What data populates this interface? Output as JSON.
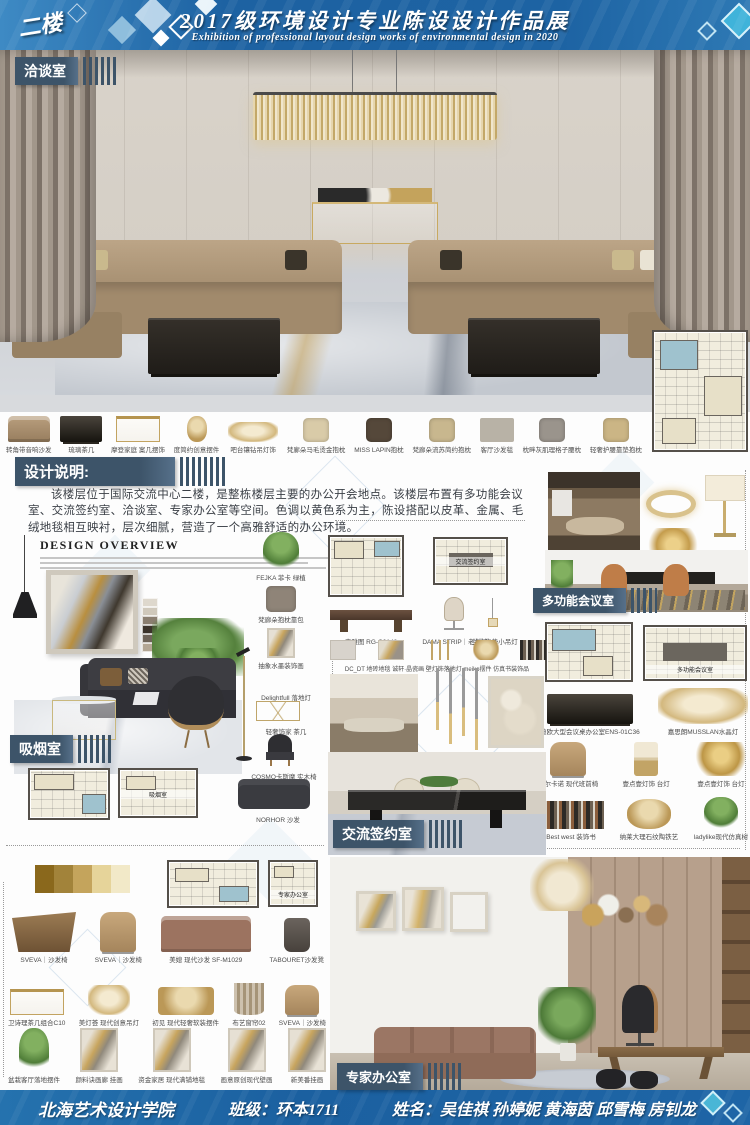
{
  "header": {
    "floor_badge": "二楼",
    "title": "2017级环境设计专业陈设设计作品展",
    "subtitle": "Exhibition of professional layout design works of environmental design in 2020"
  },
  "room_labels": {
    "negotiation": "洽谈室",
    "design_notes": "设计说明:",
    "smoking": "吸烟室",
    "signing": "交流签约室",
    "multifunction": "多功能会议室",
    "expert": "专家办公室"
  },
  "design_notes_text": "该楼层位于国际交流中心二楼，是整栋楼层主要的办公开会地点。该楼层布置有多功能会议室、交流签约室、洽谈室、专家办公室等空间。色调以黄色系为主，陈设搭配以皮革、金属、毛绒地毯相互映衬，层次细腻，营造了一个高雅舒适的办公环境。",
  "furniture_strip": {
    "items": [
      {
        "label": "转角带音响沙发",
        "kind": "sofa"
      },
      {
        "label": "琉璃茶几",
        "kind": "table"
      },
      {
        "label": "摩登家庭 案几摆饰",
        "kind": "console"
      },
      {
        "label": "度简约创意摆件",
        "kind": "decor"
      },
      {
        "label": "吧台镶钻吊灯饰",
        "kind": "chand"
      },
      {
        "label": "梵廊朵马毛烫金抱枕",
        "kind": "pillow",
        "color": "#d9cba8"
      },
      {
        "label": "MISS LAPIN抱枕",
        "kind": "pillow",
        "color": "#55483a"
      },
      {
        "label": "梵廊朵流苏简约抱枕",
        "kind": "pillow",
        "color": "#c8b78e"
      },
      {
        "label": "客厅沙发毯",
        "kind": "rug",
        "color": "#b8b2a6"
      },
      {
        "label": "枕畔灰肌理格子腰枕",
        "kind": "pillow",
        "color": "#9a948c"
      },
      {
        "label": "轻奢护腰靠垫抱枕",
        "kind": "pillow",
        "color": "#cbb585"
      }
    ]
  },
  "overview": {
    "heading": "DESIGN OVERVIEW",
    "palette": [
      "#ded8cd",
      "#cfc8bb",
      "#8a7e70",
      "#3b332b",
      "#6e6459",
      "#b3a694"
    ],
    "side_items": [
      {
        "label": "FEJKA 菲卡 绿植",
        "kind": "plant"
      },
      {
        "label": "梵廊朵抱枕靠包",
        "kind": "pillow",
        "color": "#8f8478"
      },
      {
        "label": "抽象水墨装饰画",
        "kind": "art"
      }
    ]
  },
  "smoking": {
    "floor_lamp": "Delightfull 落地灯",
    "tea_table": "轻奢饰家 茶几",
    "chair": "COSMO卡斯摩 实木椅",
    "sofa": "NORHOR 沙发"
  },
  "mid": {
    "table": "森雅图 RG-C0148",
    "boss_chair": "DAMA STRIP｜老板椅",
    "small_lamp": "兰亭集势小吊灯",
    "accessories": "DC_DT 地砖地毯 诚轩·晶瓷画 壁灯饰落地灯 meiko摆件 仿真书装饰品"
  },
  "plan_captions": {
    "signing": "交流签约室",
    "smoking": "吸烟室",
    "expert": "专家办公室",
    "multifunction": "多功能会议室"
  },
  "mf": {
    "row1": [
      {
        "label": "迪欧大型会议桌办公室ENS-01C36",
        "kind": "table"
      },
      {
        "label": "嘉思朗MUSSLAN水晶灯",
        "kind": "chand"
      }
    ],
    "row2": [
      {
        "label": "科尔卡诺 现代班前椅",
        "kind": "chair"
      },
      {
        "label": "壹点壹灯饰 台灯",
        "kind": "lamp"
      },
      {
        "label": "壹点壹灯饰 台灯",
        "kind": "palm"
      }
    ],
    "row3": [
      {
        "label": "Best west 装饰书",
        "kind": "books"
      },
      {
        "label": "纳莱大理石纹陶铁艺",
        "kind": "decor"
      },
      {
        "label": "ladylike现代仿真树",
        "kind": "plant"
      }
    ]
  },
  "expert": {
    "palette": [
      "#8a681c",
      "#a2833a",
      "#c4a45c",
      "#e6d49a",
      "#f2e9c8"
    ],
    "row1": [
      {
        "label": "SVEVA｜沙发椅",
        "kind": "desk"
      },
      {
        "label": "SVEVA｜沙发椅",
        "kind": "chair"
      },
      {
        "label": "美媳 现代沙发 SF-M1029",
        "kind": "sofa",
        "color": "#9c7360"
      },
      {
        "label": "TABOURET沙发凳",
        "kind": "stool"
      }
    ],
    "row2": [
      {
        "label": "卫诗理茶几组合C10",
        "kind": "console"
      },
      {
        "label": "美灯荟 现代创意吊灯",
        "kind": "chand"
      },
      {
        "label": "初见 现代轻奢软装摆件",
        "kind": "decor"
      },
      {
        "label": "布艺窗帘02",
        "kind": "curtain"
      },
      {
        "label": "SVEVA｜沙发椅",
        "kind": "chair"
      }
    ],
    "row3": [
      {
        "label": "盆栽客厅落地摆件",
        "kind": "plant"
      },
      {
        "label": "颜料诀画廊 挂画",
        "kind": "art"
      },
      {
        "label": "资金家居 现代满铺地毯",
        "kind": "art"
      },
      {
        "label": "画意原创现代壁画",
        "kind": "art"
      },
      {
        "label": "新美番挂画",
        "kind": "art"
      }
    ]
  },
  "footer": {
    "school": "北海艺术设计学院",
    "class_line": "班级：环本1711",
    "names_line": "姓名：吴佳祺 孙婷妮 黄海茵 邱雪梅 房钊龙"
  }
}
